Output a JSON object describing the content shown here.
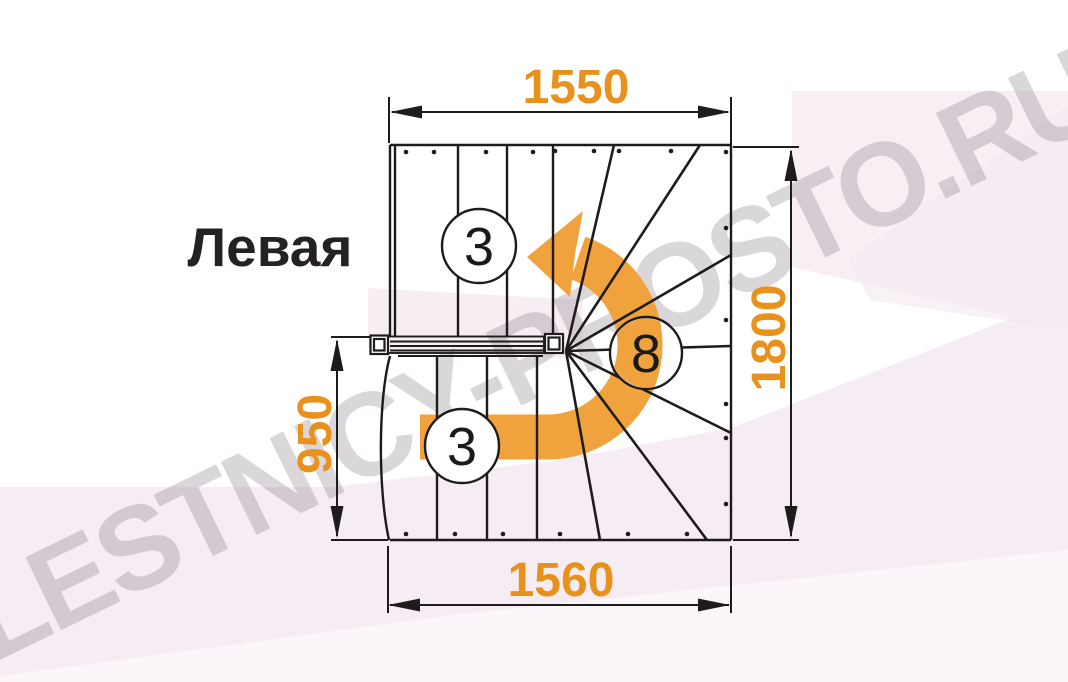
{
  "figure": {
    "title": "Левая",
    "watermark": "LESTNICY-PROSTO.RU",
    "dimensions": {
      "top": "1550",
      "right": "1800",
      "left": "950",
      "bottom": "1560"
    },
    "step_counts": {
      "top_flight": "3",
      "winders": "8",
      "bottom_flight": "3"
    },
    "colors": {
      "dimension_orange": "#E8921D",
      "arrow_orange": "#F0A23C",
      "line_black": "#1D1B1C",
      "background_pink": "#F6ECF3",
      "background_pink_light": "#F8EFF5",
      "watermark_gray": "#D9D3DA"
    }
  }
}
